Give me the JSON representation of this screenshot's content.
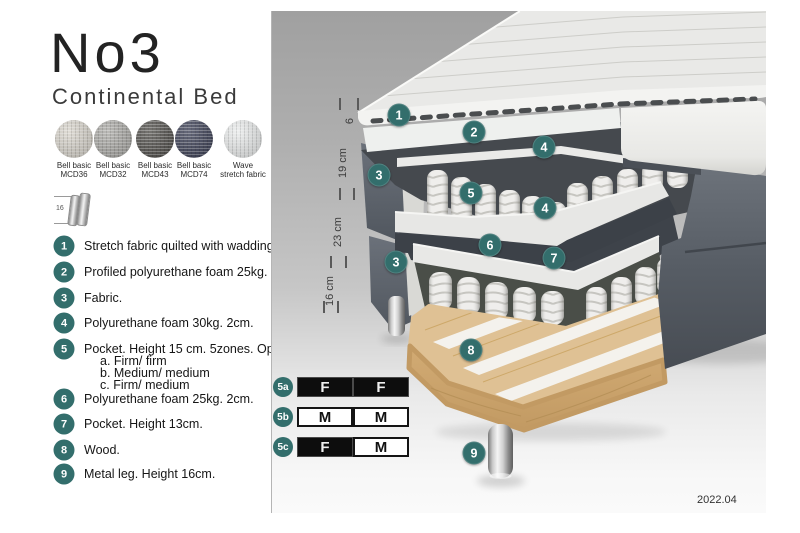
{
  "header": {
    "title": "No3",
    "subtitle": "Continental Bed"
  },
  "swatches": [
    {
      "line1": "Bell basic",
      "line2": "MCD36",
      "color": "#d7d3ca"
    },
    {
      "line1": "Bell basic",
      "line2": "MCD32",
      "color": "#a8a7a3"
    },
    {
      "line1": "Bell basic",
      "line2": "MCD43",
      "color": "#4f4d49"
    },
    {
      "line1": "Bell basic",
      "line2": "MCD74",
      "color": "#3b3f55"
    },
    {
      "line1": "Wave",
      "line2": "stretch fabric",
      "color": "#e9ebeb"
    }
  ],
  "leg_icon": {
    "dimension": "16"
  },
  "spec_list": [
    {
      "num": "1",
      "text": "Stretch fabric quilted with wadding."
    },
    {
      "num": "2",
      "text": "Profiled polyurethane foam 25kg. 4cm."
    },
    {
      "num": "3",
      "text": "Fabric."
    },
    {
      "num": "4",
      "text": "Polyurethane foam 30kg. 2cm."
    },
    {
      "num": "5",
      "text": "Pocket. Height 15 cm. 5zones. Option:",
      "options": [
        "a. Firm/ firm",
        "b. Medium/ medium",
        "c. Firm/ medium"
      ]
    },
    {
      "num": "6",
      "text": "Polyurethane foam 25kg. 2cm."
    },
    {
      "num": "7",
      "text": "Pocket. Height 13cm."
    },
    {
      "num": "8",
      "text": "Wood."
    },
    {
      "num": "9",
      "text": "Metal leg. Height 16cm."
    }
  ],
  "diagram": {
    "dimensions": [
      {
        "label": "6"
      },
      {
        "label": "19 cm"
      },
      {
        "label": "23 cm"
      },
      {
        "label": "16 cm"
      }
    ],
    "callouts": [
      {
        "num": "1"
      },
      {
        "num": "2"
      },
      {
        "num": "4"
      },
      {
        "num": "3"
      },
      {
        "num": "5"
      },
      {
        "num": "4"
      },
      {
        "num": "6"
      },
      {
        "num": "7"
      },
      {
        "num": "3"
      },
      {
        "num": "8"
      },
      {
        "num": "9"
      }
    ]
  },
  "firmness_options": [
    {
      "id": "5a",
      "cells": [
        {
          "letter": "F",
          "style": "dark"
        },
        {
          "letter": "F",
          "style": "dark"
        }
      ]
    },
    {
      "id": "5b",
      "cells": [
        {
          "letter": "M",
          "style": "light"
        },
        {
          "letter": "M",
          "style": "light"
        }
      ]
    },
    {
      "id": "5c",
      "cells": [
        {
          "letter": "F",
          "style": "dark"
        },
        {
          "letter": "M",
          "style": "light"
        }
      ]
    }
  ],
  "footer": {
    "version": "2022.04"
  },
  "colors": {
    "accent_teal": "#336e6c",
    "fabric_dark": "#5b616b",
    "wood": "#dfc194",
    "table_dark": "#0d0d0d",
    "panel_gray_top": "#a0a0a0",
    "panel_gray_bottom": "#fafafa"
  }
}
